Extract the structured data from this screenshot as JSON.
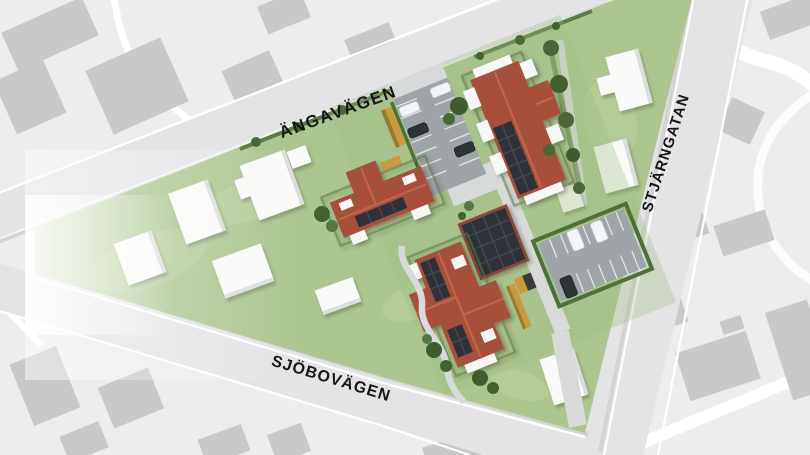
{
  "streets": {
    "top_left_road": "ÄNGAVÄGEN",
    "right_road": "STJÄRNGATAN",
    "bottom_road": "SJÖBOVÄGEN"
  },
  "colors": {
    "grass": "#adc690",
    "grass_light": "#bdd2a2",
    "roof_red": "#a6503b",
    "roof_ridge": "#c4654c",
    "solar_panel": "#2d3338",
    "asphalt": "#9ea4a8",
    "road": "#e4e4e6",
    "context_bg": "#ededef",
    "context_building": "#c9c9cb",
    "hedge_green": "#4a6836",
    "shed_yellow": "#c79b3e",
    "house_white": "#fafaf8",
    "path_gray": "#d8dad9",
    "label_text": "#161616"
  }
}
